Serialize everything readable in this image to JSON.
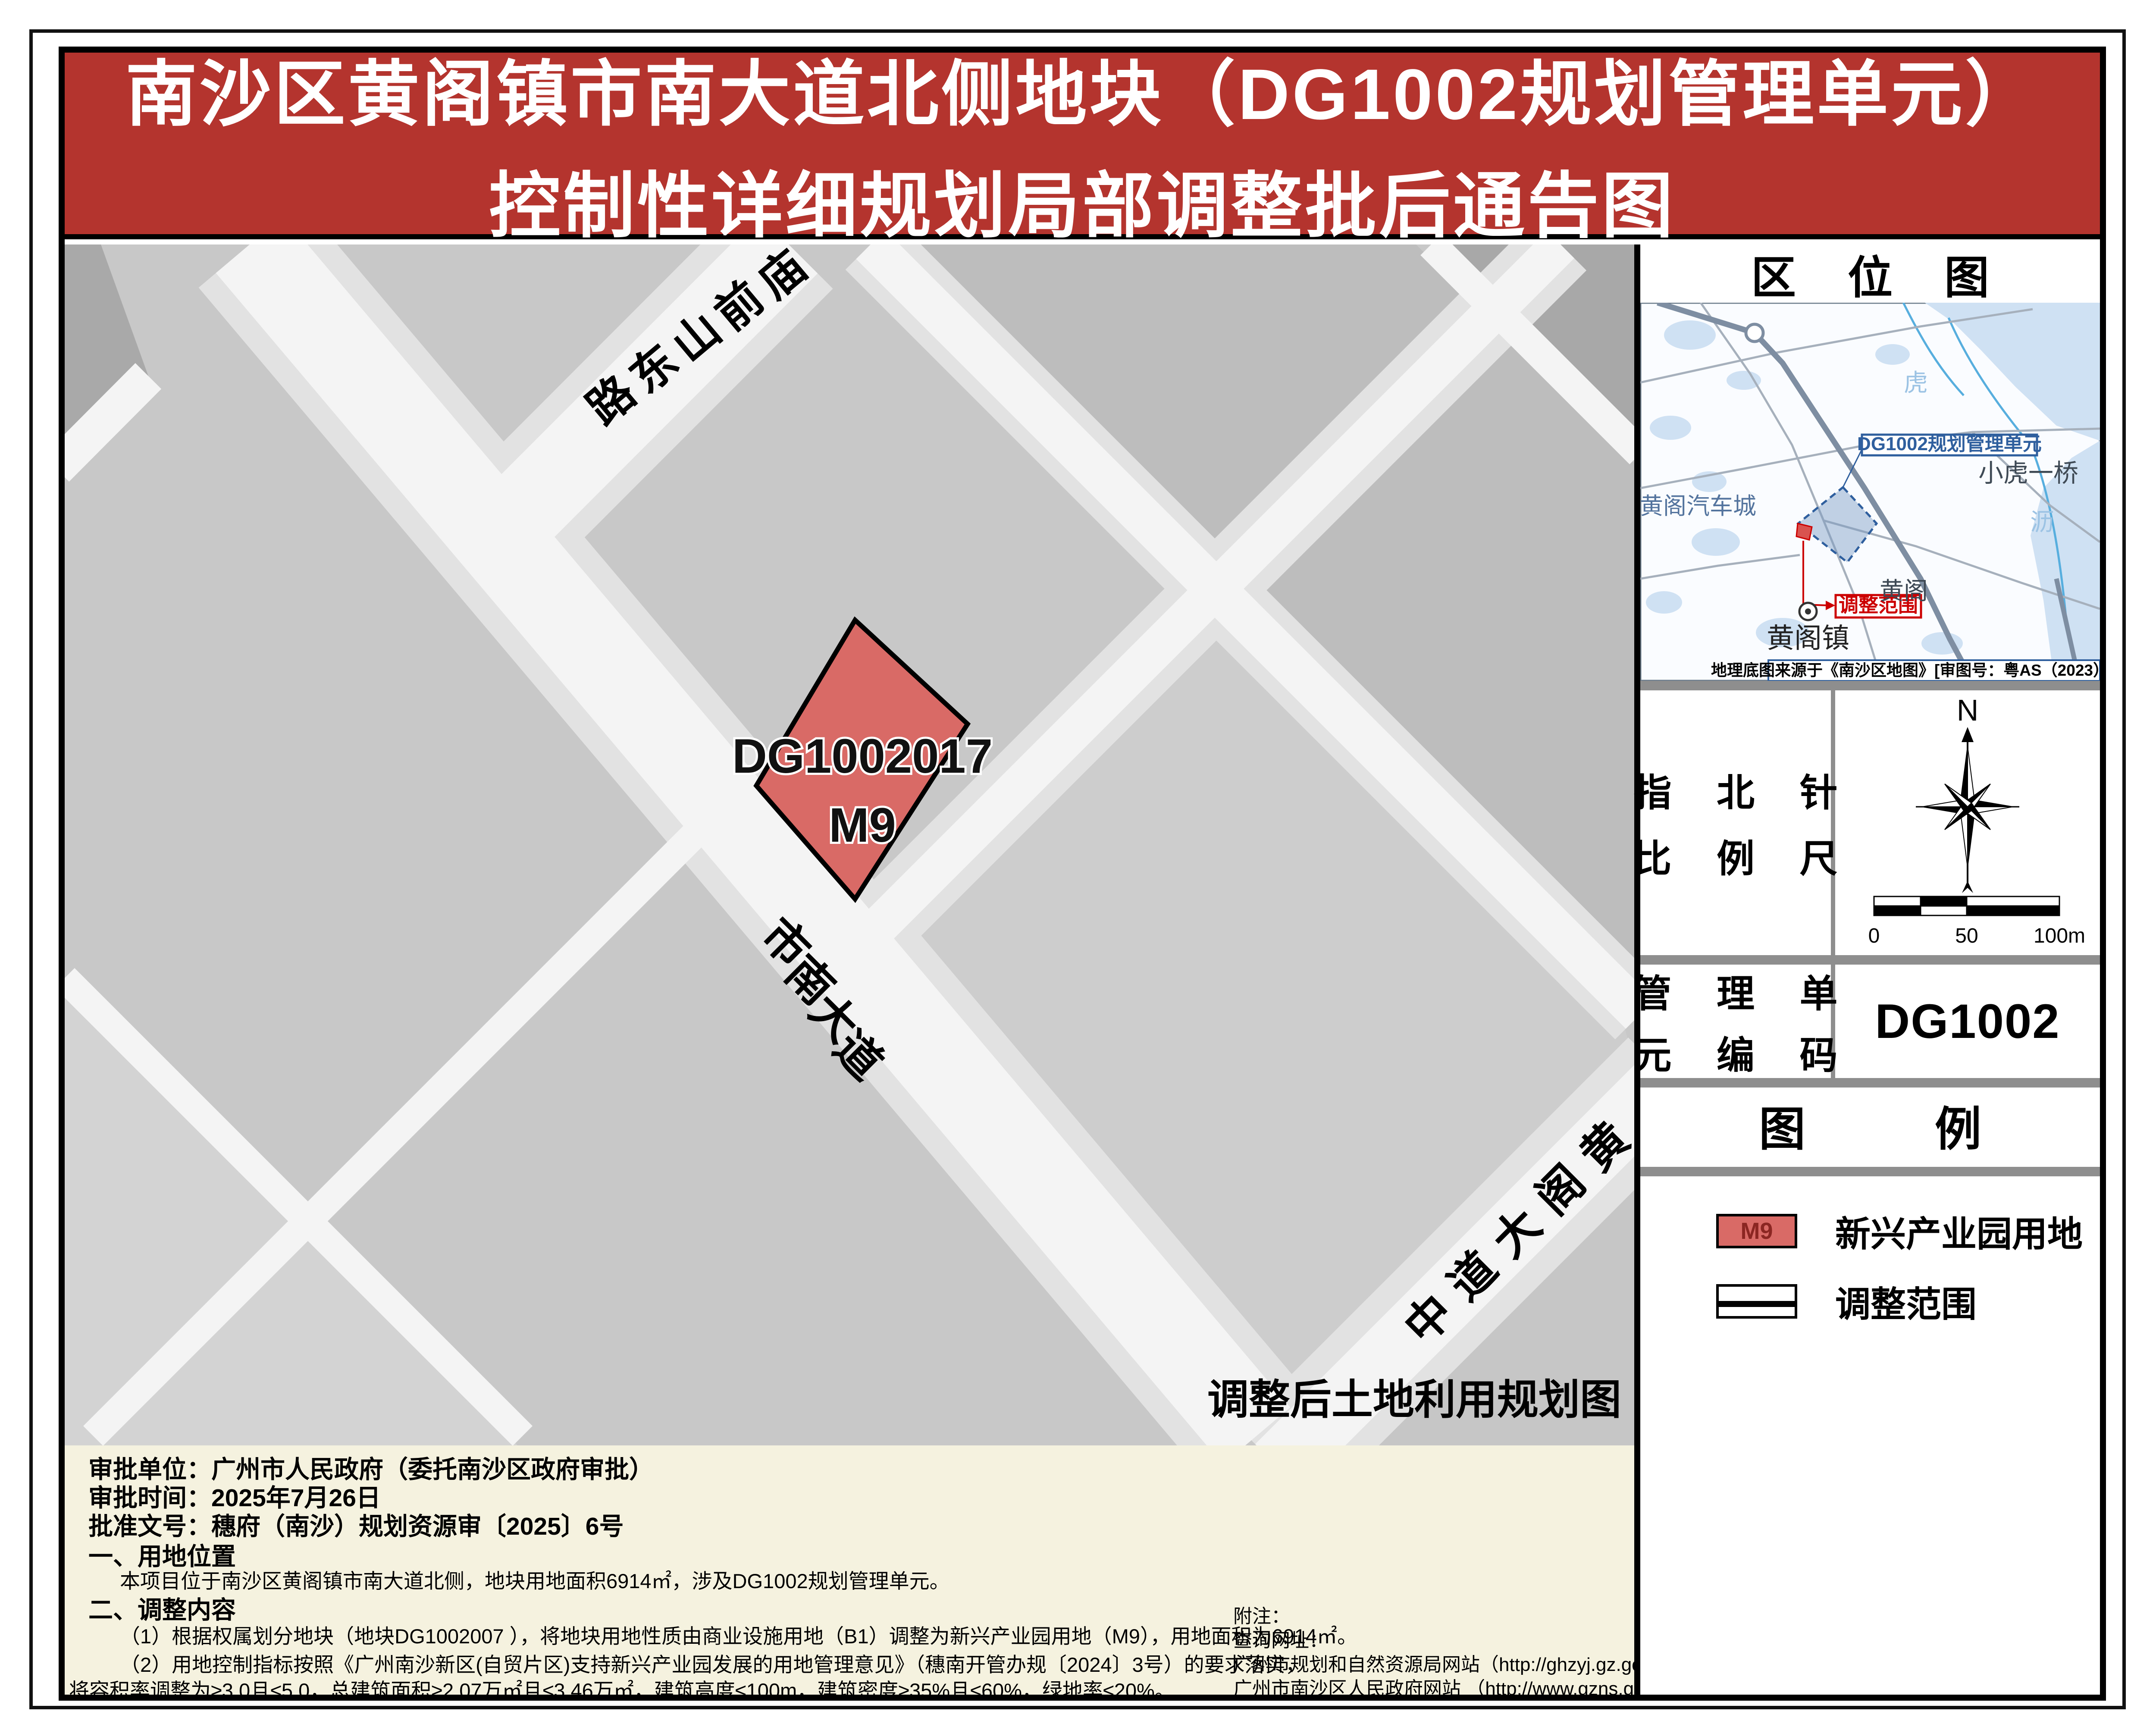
{
  "title": {
    "line1": "南沙区黄阁镇市南大道北侧地块（DG1002规划管理单元）",
    "line2": "控制性详细规划局部调整批后通告图"
  },
  "map": {
    "roads": [
      {
        "name": "庙前山东路"
      },
      {
        "name": "市南大道"
      },
      {
        "name": "黄阁大道中"
      }
    ],
    "parcel": {
      "code": "DG1002017",
      "use": "M9"
    },
    "caption": "调整后土地利用规划图"
  },
  "sidebar": {
    "location_map": {
      "header_chars": [
        "区",
        "位",
        "图"
      ],
      "unit_label": "DG1002规划管理单元",
      "scope_label": "调整范围",
      "place_auto_city": "黄阁汽车城",
      "place_bridge": "小虎一桥",
      "place_huangge": "黄阁",
      "place_town": "黄阁镇",
      "river_char1": "虎",
      "river_char2": "沥",
      "caption": "地理底图来源于《南沙区地图》[审图号：粤AS（2023）006号]"
    },
    "compass_scale": {
      "label_line1": "指 北 针",
      "label_line2": "比 例 尺",
      "north": "N",
      "tick0": "0",
      "tick50": "50",
      "tick100": "100m"
    },
    "unit_code": {
      "label_line1": "管 理 单",
      "label_line2": "元 编 码",
      "value": "DG1002"
    },
    "legend": {
      "header_chars": [
        "图",
        "例"
      ],
      "item1_swatch": "M9",
      "item1_label": "新兴产业园用地",
      "item2_label": "调整范围"
    }
  },
  "footer": {
    "approval_unit": "审批单位：广州市人民政府（委托南沙区政府审批）",
    "approval_date": "审批时间：2025年7月26日",
    "approval_doc": "批准文号：穗府（南沙）规划资源审〔2025〕6号",
    "s1_title": "一、用地位置",
    "s1_body": "本项目位于南沙区黄阁镇市南大道北侧，地块用地面积6914㎡，涉及DG1002规划管理单元。",
    "s2_title": "二、调整内容",
    "s2_item1": "（1）根据权属划分地块（地块DG1002007 ），将地块用地性质由商业设施用地（B1）调整为新兴产业园用地（M9），用地面积为6914㎡。",
    "s2_item2a": "（2）用地控制指标按照《广州南沙新区(自贸片区)支持新兴产业园发展的用地管理意见》（穗南开管办规〔2024〕3号）的要求落实，",
    "s2_item2b": "将容积率调整为≥3.0且≤5.0，总建筑面积≥2.07万㎡且≤3.46万㎡，建筑高度≤100m，建筑密度≥35%且≤60%，绿地率≤20%。",
    "notes0": "附注：",
    "notes1": "查询网址：",
    "notes2": "广州市规划和自然资源局网站（http://ghzyj.gz.gov.cn/），",
    "notes3": "广州市南沙区人民政府网站 （http://www.gzns.gov.cn/）。"
  },
  "colors": {
    "banner_red": "#b4342e",
    "parcel_red": "#d96a66",
    "cream": "#f5f2df",
    "blue": "#2f5f9e",
    "scope_red": "#cc0000"
  }
}
